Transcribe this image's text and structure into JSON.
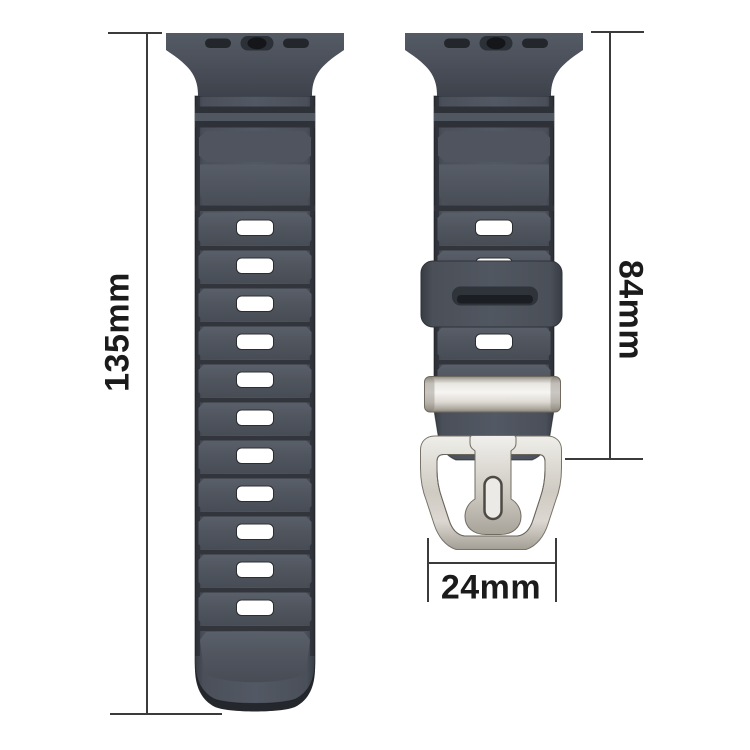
{
  "diagram": {
    "type": "product-dimension-diagram",
    "subject": "watch-band-with-buckle",
    "background_color": "#ffffff",
    "line_color": "#3b3b3b",
    "text_color": "#1b1b1b",
    "strap_color": "#4a4f59",
    "strap_groove_color": "#2e3138",
    "hole_color": "#ffffff",
    "metal_color": "#d9d6cf"
  },
  "measurements": {
    "long_strap_length": {
      "label": "135mm",
      "side": "left",
      "orientation": "vertical"
    },
    "short_strap_length": {
      "label": "84mm",
      "side": "right",
      "orientation": "vertical"
    },
    "buckle_width": {
      "label": "24mm",
      "side": "bottom",
      "orientation": "horizontal"
    }
  }
}
